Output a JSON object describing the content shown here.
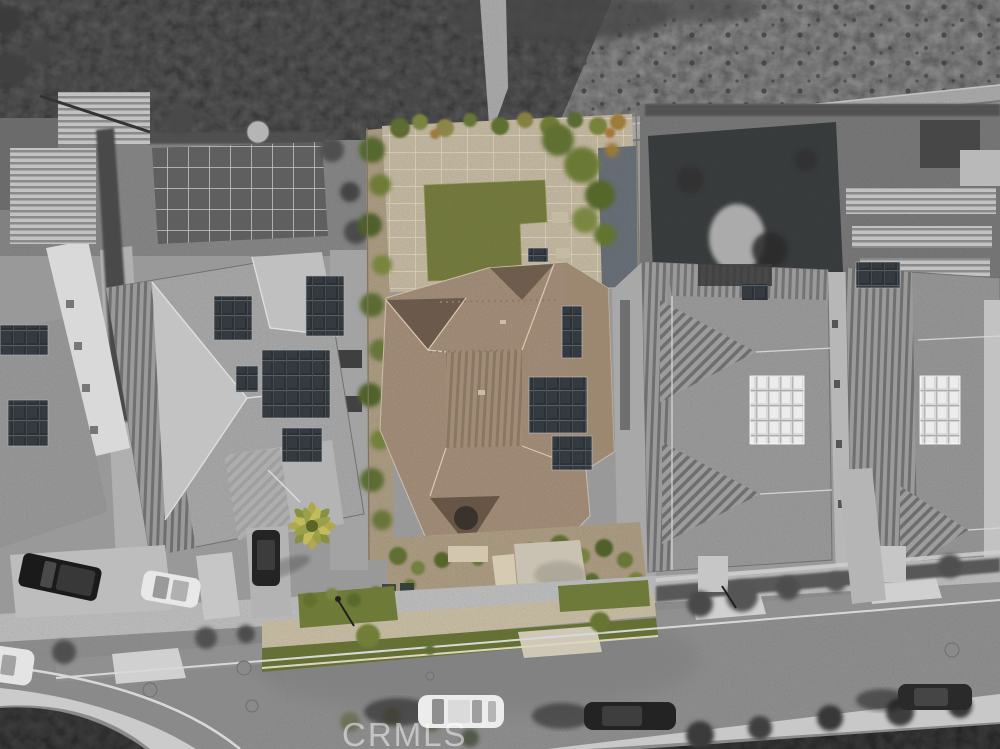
{
  "scene": {
    "type": "aerial-photo",
    "description": "Top-down aerial drone photo of a residential street. The subject home (tan tile hip roof, solar panels, green back lawn, paver patio, palm tree) is shown in color while neighboring homes, the street and the scrub hillside behind are desaturated grayscale.",
    "watermark": "CRMLS"
  },
  "subject_property": {
    "label": "subject-home-highlighted-in-color",
    "features": [
      "tan-tile-hip-roof",
      "ribbed-roof-section",
      "entry-gable",
      "solar-panel-arrays",
      "green-back-lawn",
      "paver-patio",
      "side-yard-trees",
      "front-landscaping",
      "palm-tree",
      "front-walkway",
      "driveway"
    ]
  },
  "neighborhood": {
    "hillside": "undeveloped-scrub-slope-with-trail",
    "left_neighbor": "gray-hip-roof-home-with-dark-solar-panels",
    "right_neighbor": "gray-ridged-roof-home-with-bright-solar-array",
    "far_right_neighbor": "gray-ridged-roof-home-with-solar-panels",
    "far_left_home": "partial-gray-roof-with-white-pergola",
    "right_backyard": "dark-patio-with-spa-and-pergolas",
    "street": "curved-residential-street-with-sidewalks-and-parkway-grass"
  },
  "vehicles": [
    "black-pickup-truck",
    "white-hatchback",
    "dark-van",
    "white-suv",
    "dark-sedan",
    "dark-sedan-right",
    "white-car-partial"
  ],
  "colors": {
    "subject_roof_tan": "#a8937d",
    "subject_roof_shadow": "#6e5d4d",
    "lawn_green": "#7a8142",
    "tree_green": "#64742f",
    "palm_green": "#afa84e",
    "paver_tan": "#cbbfa7",
    "gravel_tan": "#b2a287",
    "sidewalk_tan": "#cfc4aa",
    "asphalt_gray": "#959595",
    "sidewalk_gray": "#c6c6c6",
    "scrub_dark": "#5e5e5e",
    "field_gray": "#969696",
    "roof_gray": "#aeaeae",
    "solar_dark": "#2c3135",
    "solar_bright": "#d9d9d9",
    "vegetation_dark": "#454545",
    "watermark_color": "#ffffff"
  }
}
